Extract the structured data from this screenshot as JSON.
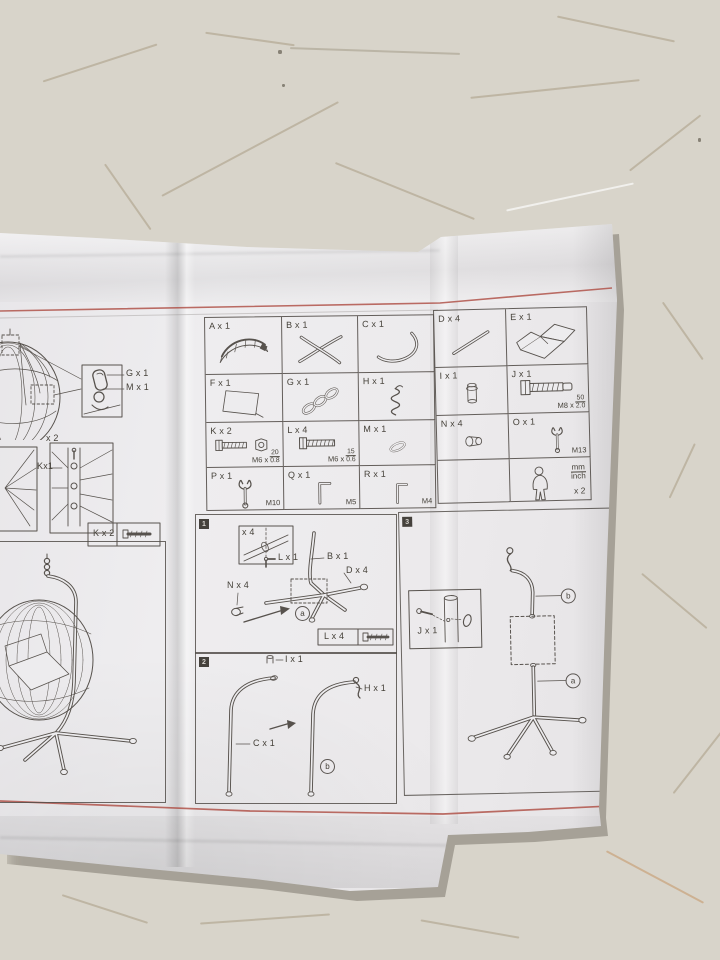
{
  "sheet": {
    "left": {
      "legend_g": "G x 1",
      "legend_m": "M x 1",
      "multiplier_x2": "x 2",
      "label_k1": "Kx1",
      "legend_k2": "K x 2"
    },
    "step1": {
      "num": "1",
      "inset_qty": "x 4",
      "lbl_l1": "L x 1",
      "lbl_b1": "B x 1",
      "lbl_d4": "D x 4",
      "lbl_n4": "N x 4",
      "circle_a": "a",
      "legend_l4": "L x 4"
    },
    "step2": {
      "num": "2",
      "lbl_i1": "I x 1",
      "lbl_h1": "H x 1",
      "lbl_c1": "C x 1",
      "circle_b": "b"
    },
    "step3": {
      "num": "3",
      "lbl_j1": "J x 1",
      "circle_b": "b",
      "circle_a": "a"
    }
  },
  "parts_table": {
    "rows": [
      {
        "cells": [
          {
            "label": "A x 1"
          },
          {
            "label": "B x 1"
          },
          {
            "label": "C x 1"
          },
          {
            "label": "D x 4"
          },
          {
            "label": "E x 1"
          }
        ]
      },
      {
        "cells": [
          {
            "label": "F x 1"
          },
          {
            "label": "G x 1"
          },
          {
            "label": "H x 1"
          },
          {
            "label": "I x 1"
          },
          {
            "label": "J x 1",
            "spec_prefix": "M8 x",
            "spec_num": "50",
            "spec_den": "2.0"
          }
        ]
      },
      {
        "cells": [
          {
            "label": "K x 2",
            "spec_prefix": "M6 x",
            "spec_num": "20",
            "spec_den": "0.8"
          },
          {
            "label": "L x 4",
            "spec_prefix": "M6 x",
            "spec_num": "15",
            "spec_den": "0.6"
          },
          {
            "label": "M x 1"
          },
          {
            "label": "N x 4"
          },
          {
            "label": "O x 1",
            "spec": "M13"
          }
        ]
      },
      {
        "cells": [
          {
            "label": "P x 1",
            "spec": "M10"
          },
          {
            "label": "Q x 1",
            "spec": "M5"
          },
          {
            "label": "R x 1",
            "spec": "M4"
          },
          {
            "label": ""
          },
          {
            "label": "",
            "unit_top": "mm",
            "unit_bottom": "inch",
            "qty": "x 2"
          }
        ]
      }
    ]
  },
  "colors": {
    "red_line": "#b0544a",
    "ink": "#454139",
    "paper": "#eceaec",
    "floor": "#ddd8cd"
  }
}
